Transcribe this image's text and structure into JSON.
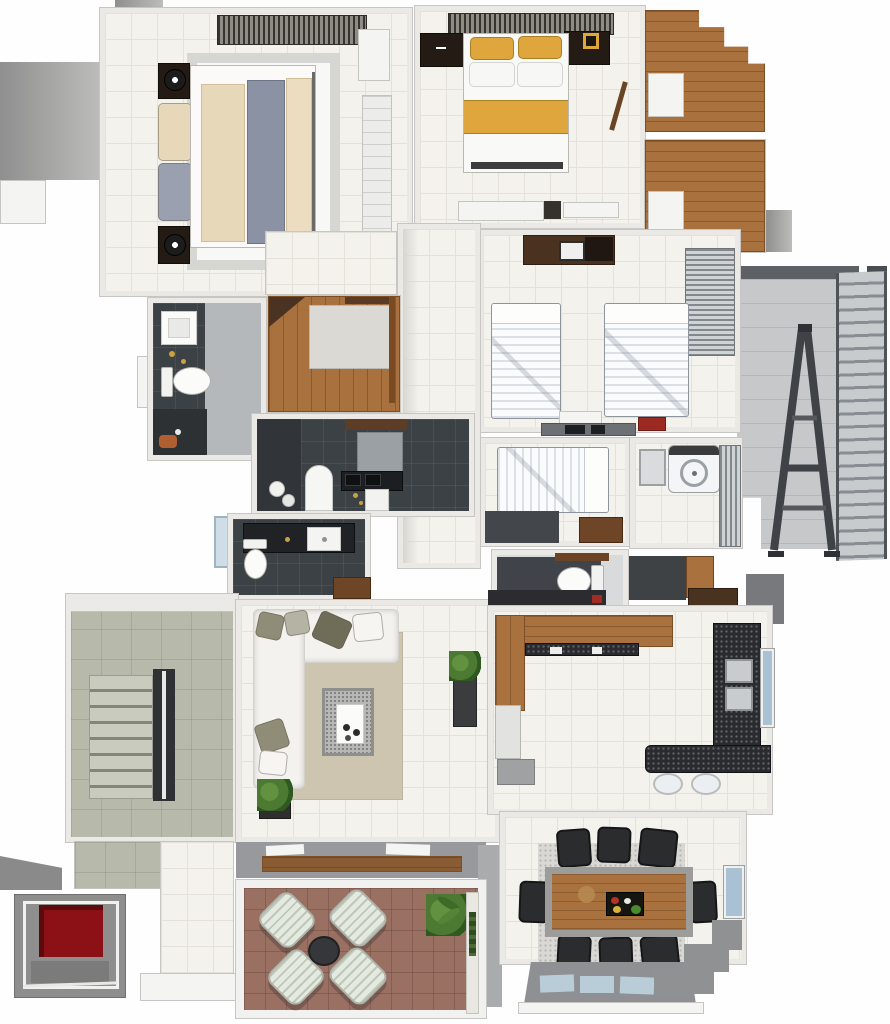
{
  "meta": {
    "kind": "3d-rendered apartment floor plan, top-down view",
    "visible_text": [],
    "canvas": {
      "width_px": 890,
      "height_px": 1024
    }
  },
  "palette": {
    "tile": "#f3f2ed",
    "tile_line": "#e3e1d8",
    "wood": "#a8713e",
    "wood_dark": "#6f4527",
    "bath_dark": "#3c4145",
    "stair_floor": "#b7b9ab",
    "balcony_floor": "#c6c8ca",
    "patio_floor": "#9a7063",
    "rug_beige": "#cdc5b0",
    "rug_gray": "#dad8d4",
    "sofa": "#f3f2ef",
    "granite": "#2a2b2f",
    "bed_yellow": "#dfa63d",
    "bed_cream": "#e8d8ba",
    "bed_runner": "#8b92a4",
    "elevator_red": "#8c1116",
    "window_blue": "#aac1d3",
    "plant_green": "#4c7a33",
    "chair_dark": "#2b2c2e",
    "metal": "#3f4347",
    "wall_shadow": "#9b9b9b"
  },
  "rooms": [
    {
      "id": "bedroom-master",
      "label": "bedroom: double bed with cream bedding and gray-blue runner, two nightstands with lamps, striped wardrobe, rug"
    },
    {
      "id": "bedroom-yellow",
      "label": "bedroom: double bed with yellow pillows and yellow band, nightstands, framed yellow picture, wardrobe, dresser"
    },
    {
      "id": "closet-upper",
      "label": "walk-in closet, wood floor, stepped wall, door"
    },
    {
      "id": "closet-lower",
      "label": "walk-in closet, wood floor, door"
    },
    {
      "id": "service-balcony",
      "label": "side balcony: A-frame ladder, exterior stair, railing"
    },
    {
      "id": "bedroom-twin",
      "label": "bedroom: two single beds with white striped duvets, cabinet, blinds closet, desk with red box"
    },
    {
      "id": "bedroom-single",
      "label": "bedroom: single bed, wood door"
    },
    {
      "id": "laundry",
      "label": "laundry: top-load washer, utility tub, louver screen"
    },
    {
      "id": "wc",
      "label": "toilet room with white toilet"
    },
    {
      "id": "hallway",
      "label": "hallway, tile floor"
    },
    {
      "id": "bathroom-1",
      "label": "bathroom: square basin, toilet, shower"
    },
    {
      "id": "closet-l",
      "label": "L-shaped closet, wood floor, gray inset"
    },
    {
      "id": "bathroom-2",
      "label": "dark bathroom: tub, vanity with basin, shower pan"
    },
    {
      "id": "bathroom-3",
      "label": "dark bathroom: basin counter, toilet, wood door"
    },
    {
      "id": "stairwell",
      "label": "stairwell: steps, center railing, landing"
    },
    {
      "id": "elevator",
      "label": "elevator shaft with red cab floor"
    },
    {
      "id": "living",
      "label": "living room: white L-sofa with pillows, beige rug, speckled coffee table, plants"
    },
    {
      "id": "kitchen",
      "label": "kitchen: wood counter, granite counters, double sink, window, breakfast bar with two stools"
    },
    {
      "id": "dining",
      "label": "dining: 8 dark chairs, wood-top table with serving tray, gray rug, windows"
    },
    {
      "id": "patio",
      "label": "terrace: four pleated armchairs, round dark table, plants, wood bench"
    }
  ]
}
